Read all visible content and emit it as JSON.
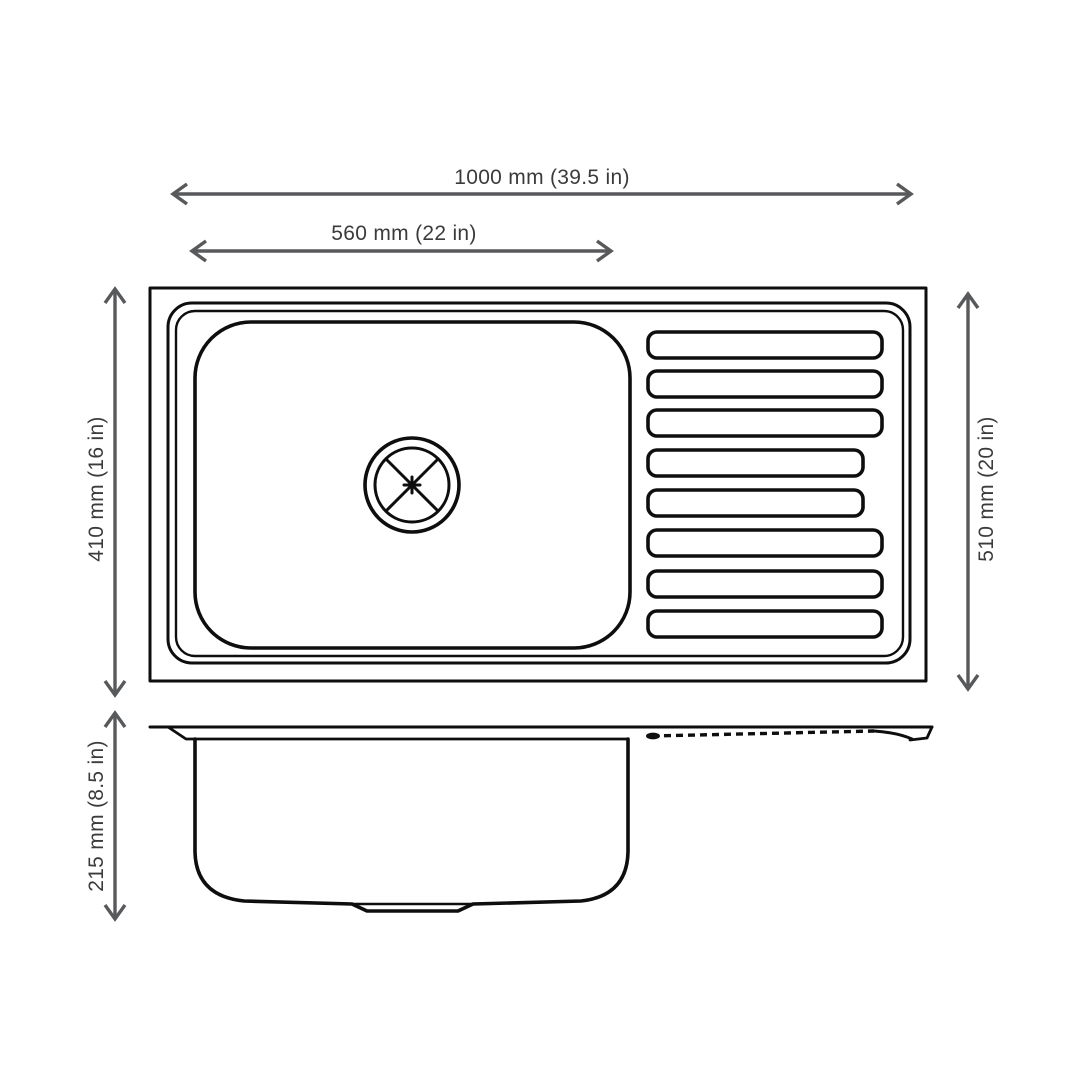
{
  "figure": {
    "dimensions": {
      "overall_width": "1000 mm (39.5 in)",
      "bowl_width": "560 mm (22 in)",
      "bowl_front_to_back": "410 mm (16 in)",
      "overall_front_to_back": "510 mm (20 in)",
      "bowl_depth": "215 mm (8.5 in)"
    },
    "top_view": {
      "drainboard_groove_count": 8
    },
    "colors": {
      "background": "#ffffff",
      "outline": "#0e0e0e",
      "dimension_line": "#58595b",
      "dimension_text": "#3b3b3b"
    }
  }
}
